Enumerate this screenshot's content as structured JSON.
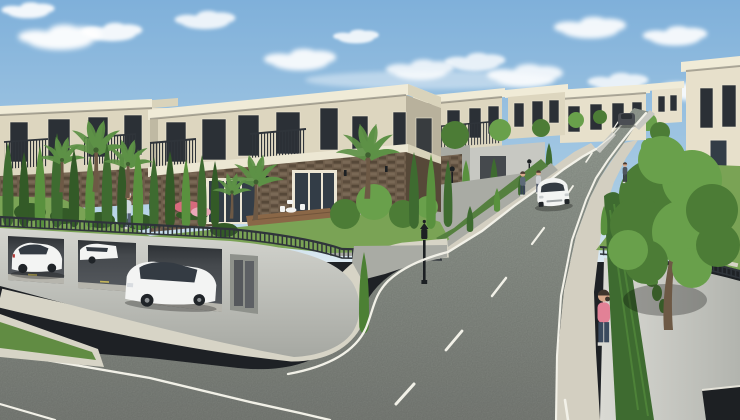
{
  "scene": {
    "type": "3d-architectural-rendering",
    "title": "Modern two-storey villa complex with terraced gardens, underground parking garage and an uphill street under a blue sky with scattered clouds",
    "inventory": {
      "foreground_villas": 2,
      "hillside_villas": 5,
      "garage_parked_cars": 3,
      "cars_on_street": 2,
      "pedestrians": 6,
      "street_lamps": 3,
      "garden_bollards": 1,
      "palm_trees": 6
    }
  },
  "palette": {
    "sky_top": "#7fb0da",
    "sky_mid": "#a8cbe4",
    "sky_low": "#dce9f1",
    "cloud": "#ffffff",
    "roof": "#f0ebd7",
    "roof_side": "#d9d3bb",
    "wall_beige": "#ddd6bf",
    "wall_dark": "#b8b19c",
    "wall_cream2": "#e7e0cb",
    "slab": "#ece7d3",
    "window_dark": "#2b3036",
    "window_frame": "#ece6d4",
    "glass": "#333d47",
    "railing": "#2f343a",
    "stone_mid": "#6d5c4a",
    "stone_dark": "#564838",
    "stone_light": "#80705c",
    "deck": "#8a6747",
    "table_white": "#f2f3f1",
    "grass": "#7aa355",
    "grass_dark": "#618c43",
    "hedge": "#3e6b30",
    "hedge_dark": "#335a27",
    "hedge_light": "#59913e",
    "palm": "#5d9146",
    "tree": "#4c7c36",
    "tree_light": "#69a04b",
    "trunk": "#6d5945",
    "concrete": "#c7c8c2",
    "concrete_dark": "#a9aba4",
    "concrete_deep": "#8e918b",
    "garage_dark": "#45494d",
    "garage_deep": "#2e3236",
    "garage_floor": "#c8c6bb",
    "apron": "#d7d4c6",
    "sidewalk": "#d3cfc1",
    "asphalt": "#7f837d",
    "asphalt_light": "#9ba399",
    "line_white": "#f2f1e8",
    "line_yellow": "#d9c75c",
    "car_white": "#f3f4f3",
    "car_grey": "#4b4e53",
    "car_glass": "#343b43",
    "wheel": "#202428",
    "lamp": "#1c2023",
    "shadow": "#000000",
    "skin": "#d8a88b",
    "pink": "#e28196",
    "dark_jeans": "#3b4a5e",
    "flower1": "#d76a7d",
    "flower2": "#eaa8b8",
    "ivy": "#4e7f38"
  }
}
